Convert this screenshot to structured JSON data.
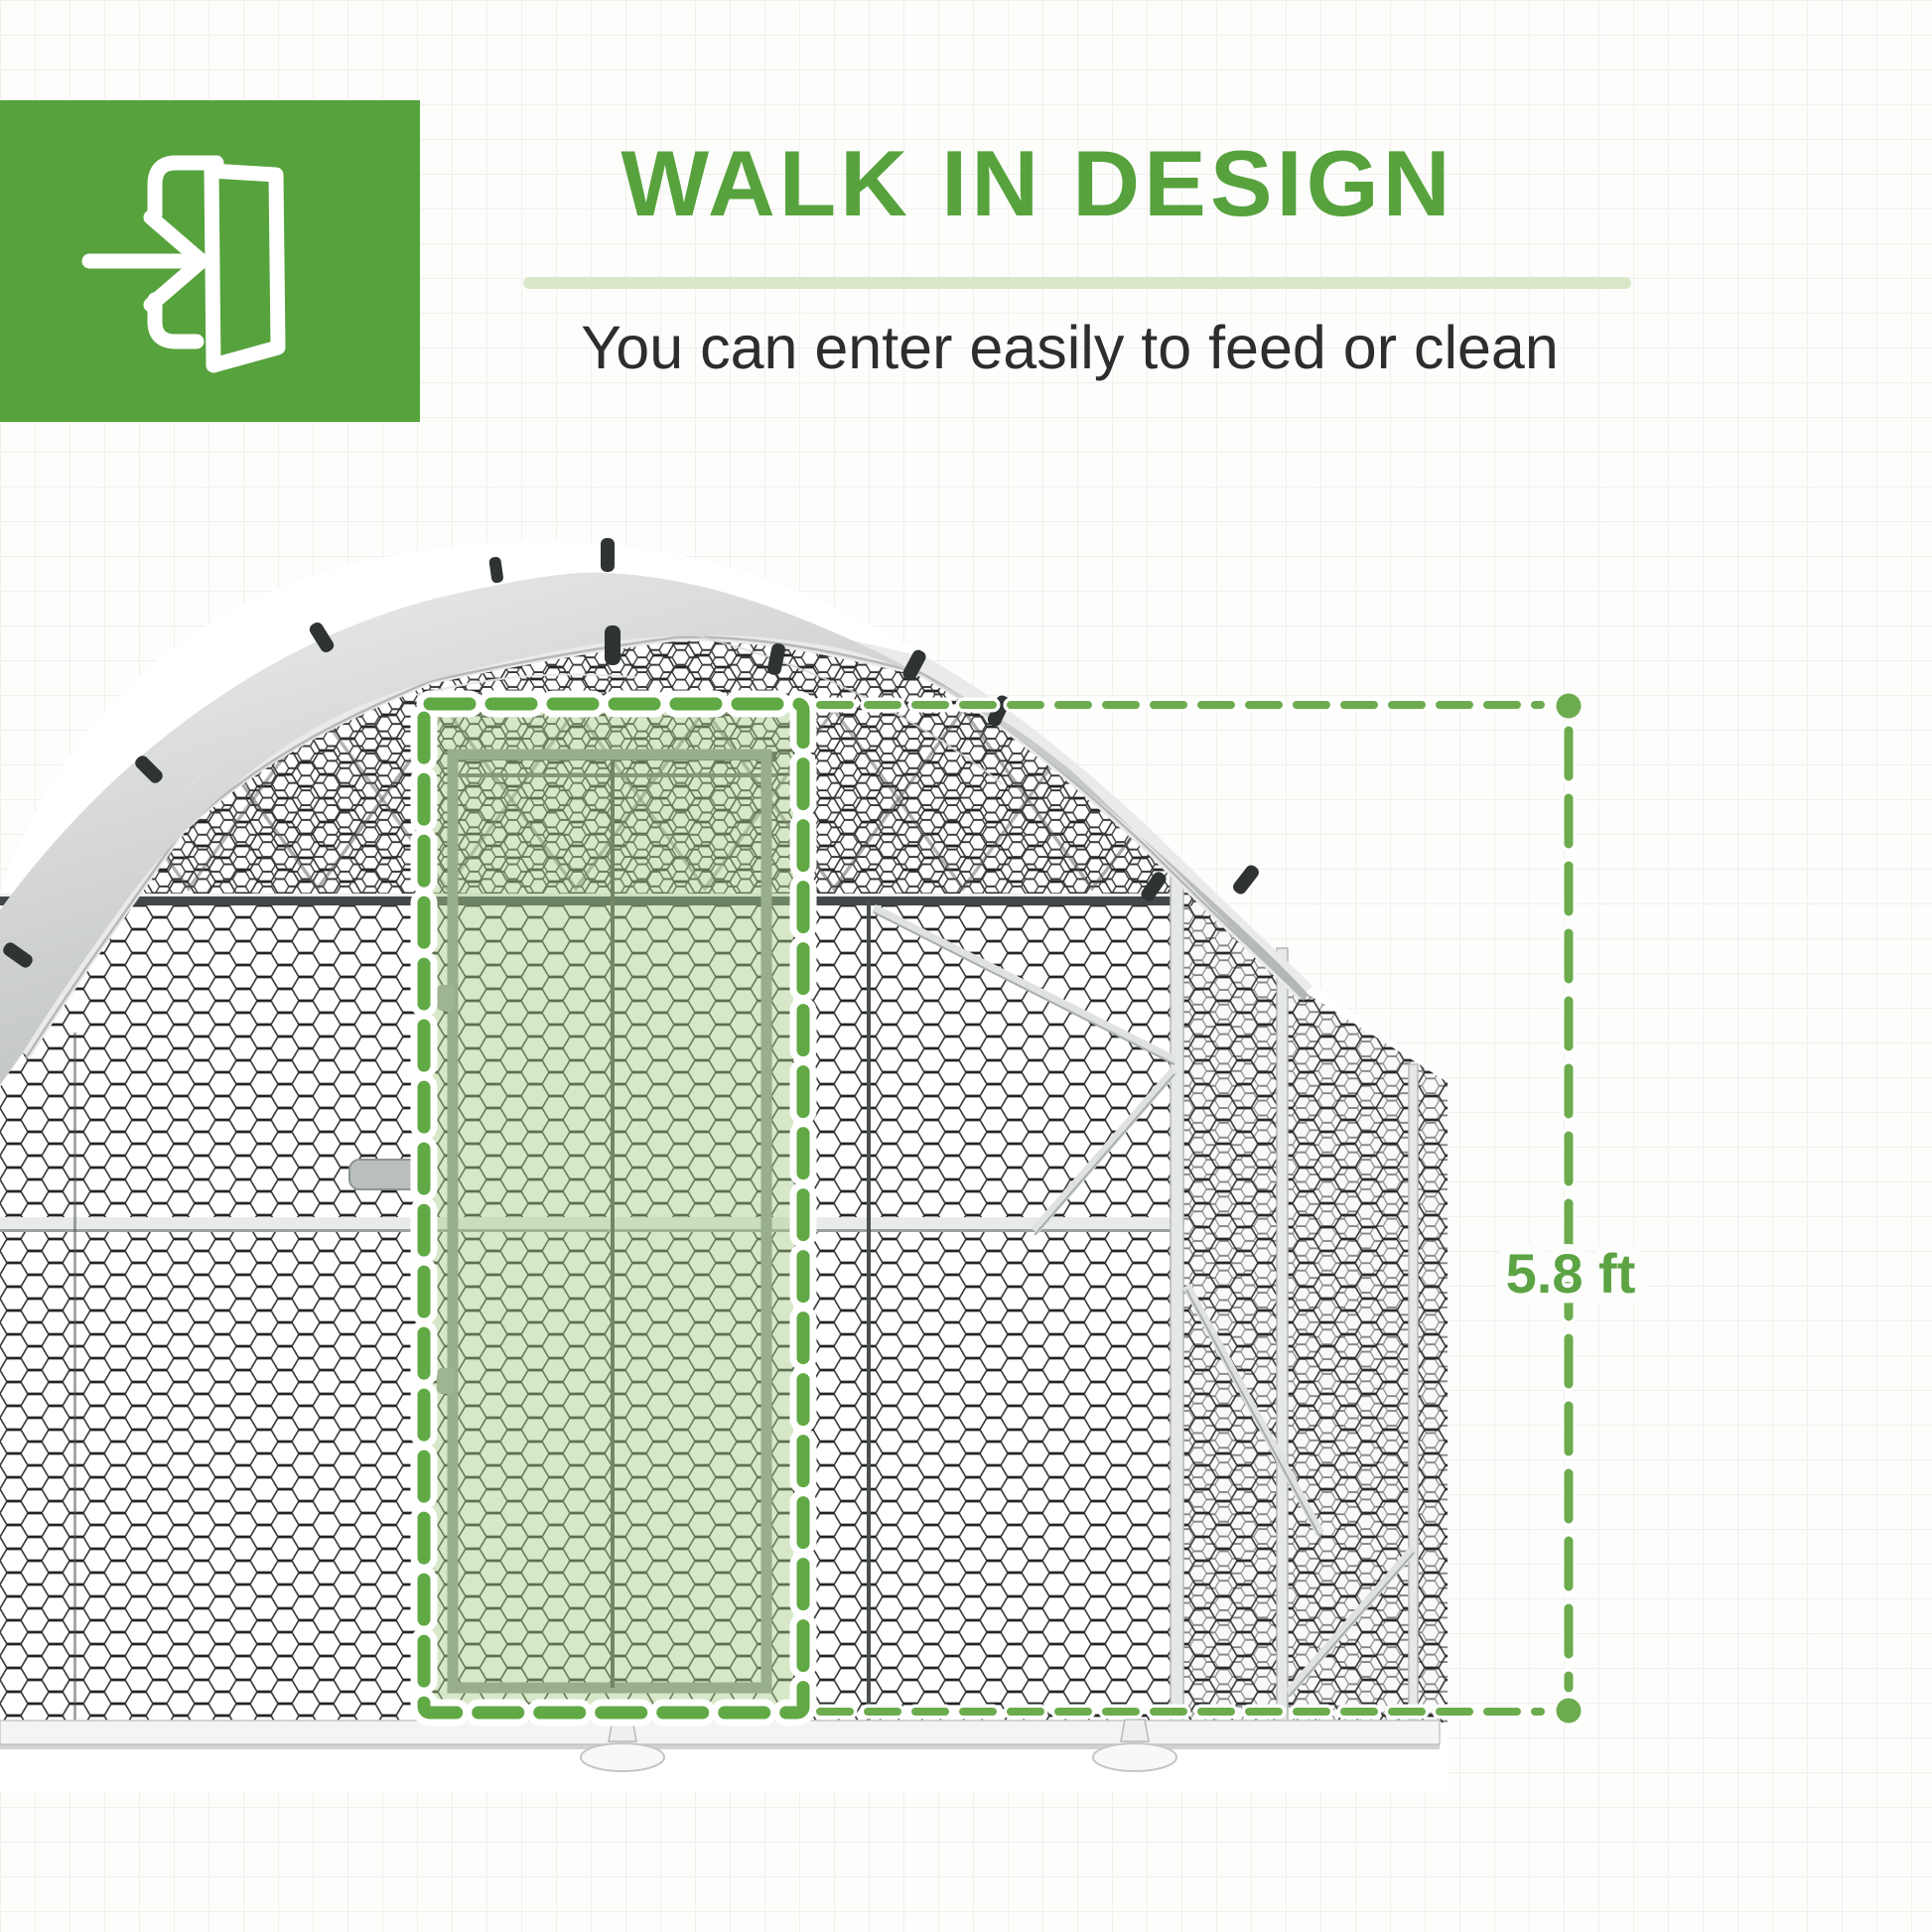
{
  "badge": {
    "icon": "door-enter-icon",
    "bg_color": "#56a23c",
    "icon_color": "#ffffff"
  },
  "header": {
    "title": "WALK IN DESIGN",
    "title_color": "#57a23d",
    "divider_color": "#d8e7c7",
    "subtitle": "You can enter easily to feed or clean",
    "subtitle_color": "#2d2d2d"
  },
  "figure": {
    "description": "Walk-in metal chicken run with gray dome roof cover, hexagonal wire mesh walls, and walk-in door highlighted by a green dashed rectangle",
    "door_highlight_color": "#61a944",
    "door_tint_color": "#a6cc86",
    "dimension": {
      "label": "5.8 ft",
      "line_color": "#6cac4e",
      "label_color": "#5ca343"
    }
  }
}
